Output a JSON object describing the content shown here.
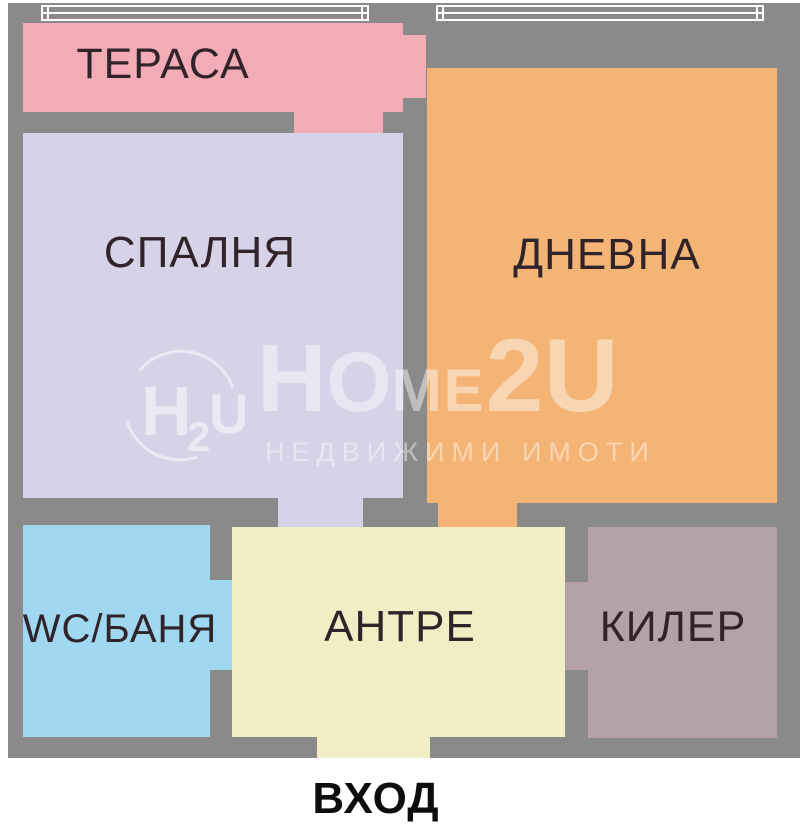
{
  "plan": {
    "wall_color": "#8a8a8a",
    "rooms": {
      "terrace": {
        "label": "ТЕРАСА",
        "color": "#f3acb5"
      },
      "bedroom": {
        "label": "СПАЛНЯ",
        "color": "#d6d2e8"
      },
      "living": {
        "label": "ДНЕВНА",
        "color": "#f4b476"
      },
      "wc": {
        "label": "WC/БАНЯ",
        "color": "#a0d8f2"
      },
      "hall": {
        "label": "АНТРЕ",
        "color": "#f1eec6"
      },
      "closet": {
        "label": "КИЛЕР",
        "color": "#b4a2a7"
      }
    },
    "label_color": "#30232a",
    "entrance": {
      "label": "ВХОД"
    }
  },
  "watermark": {
    "logo": {
      "h": "H",
      "sub": "2",
      "u": "U"
    },
    "brand": {
      "part1": "H",
      "part2": "O",
      "part3": "ME",
      "part4": "2U"
    },
    "tagline": "НЕДВИЖИМИ  ИМОТИ"
  }
}
